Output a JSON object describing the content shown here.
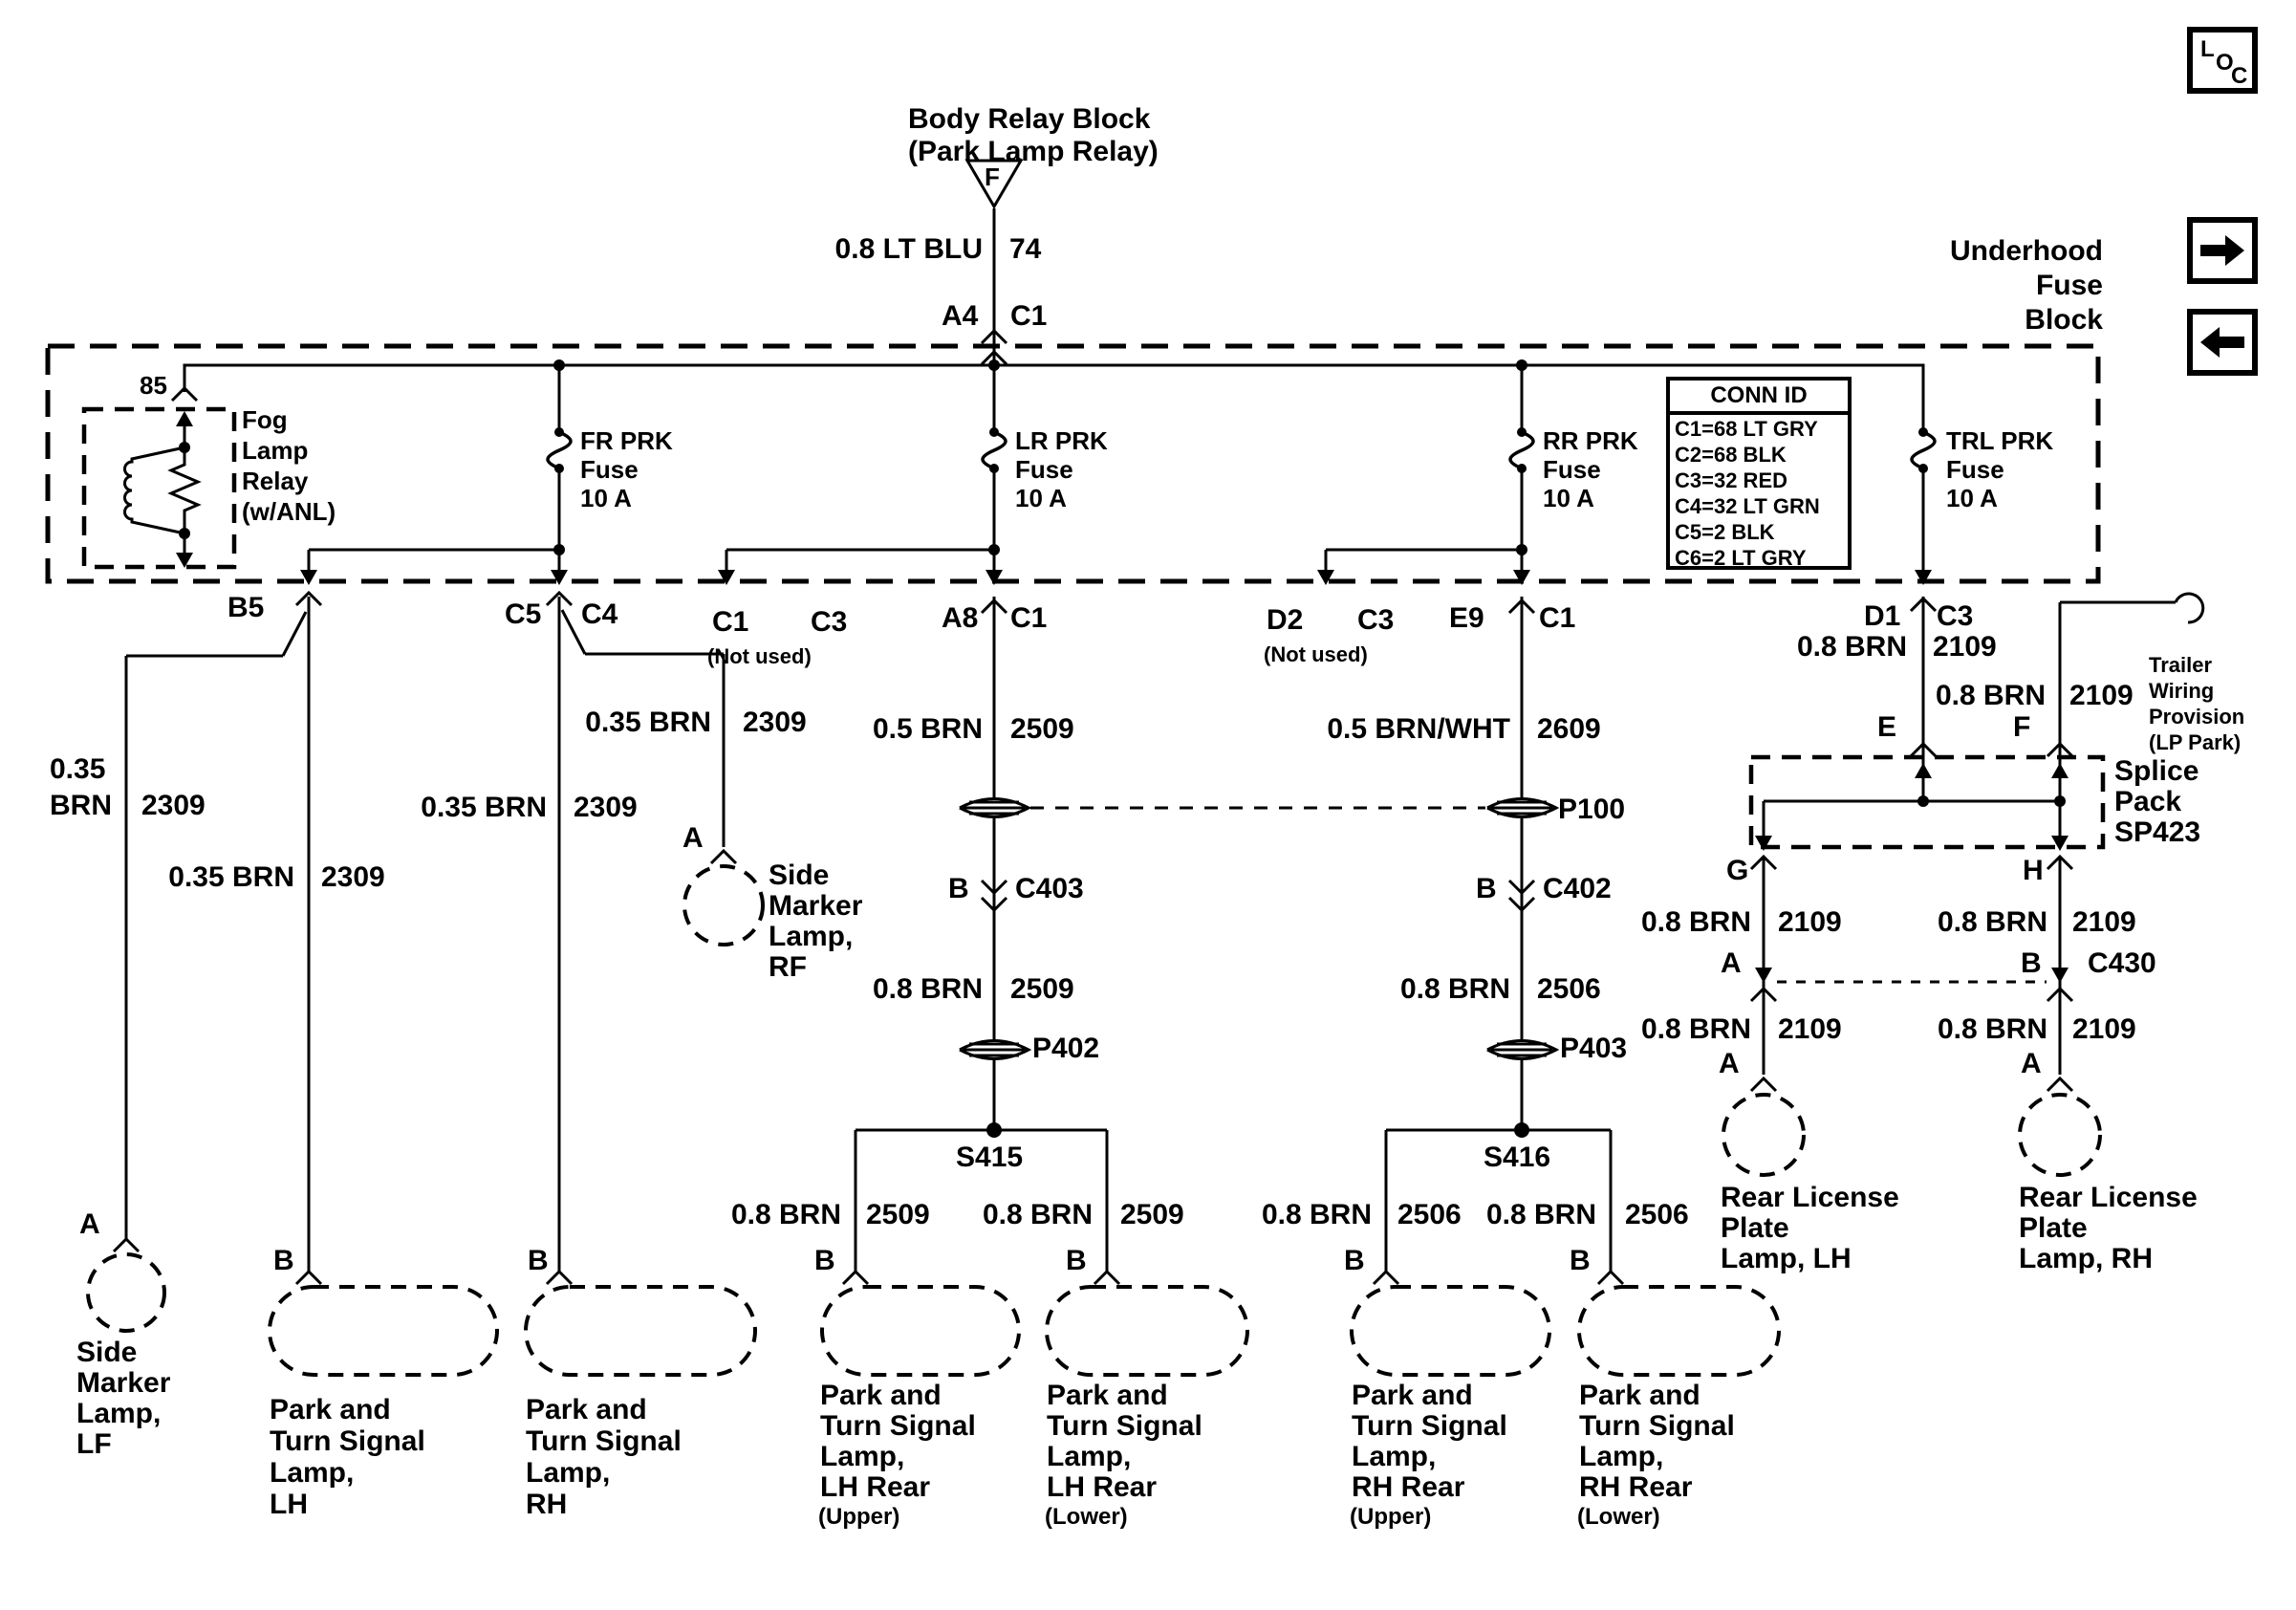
{
  "header": {
    "relay_block": [
      "Body Relay Block",
      "(Park Lamp Relay)"
    ],
    "triangle_letter": "F",
    "feed": {
      "color": "0.8 LT BLU",
      "circuit": "74",
      "pin": "A4",
      "conn": "C1"
    },
    "fuse_block_title": [
      "Underhood",
      "Fuse",
      "Block"
    ]
  },
  "nav": {
    "loc": [
      "L",
      "O",
      "C"
    ]
  },
  "fuse_block": {
    "relay": {
      "pin": "85",
      "name": [
        "Fog",
        "Lamp",
        "Relay",
        "(w/ANL)"
      ]
    },
    "fuses": {
      "fr": [
        "FR PRK",
        "Fuse",
        "10 A"
      ],
      "lr": [
        "LR PRK",
        "Fuse",
        "10 A"
      ],
      "rr": [
        "RR PRK",
        "Fuse",
        "10 A"
      ],
      "trl": [
        "TRL PRK",
        "Fuse",
        "10 A"
      ]
    },
    "conn_id": {
      "title": "CONN ID",
      "rows": [
        "C1=68 LT GRY",
        "C2=68 BLK",
        "C3=32 RED",
        "C4=32 LT GRN",
        "C5=2 BLK",
        "C6=2 LT GRY"
      ]
    }
  },
  "pins": {
    "b5": "B5",
    "c5": "C5",
    "c4": "C4",
    "nu1": {
      "a": "C1",
      "b": "C3",
      "note": "(Not used)"
    },
    "a8": {
      "pin": "A8",
      "conn": "C1"
    },
    "nu2": {
      "a": "D2",
      "b": "C3",
      "note": "(Not used)"
    },
    "e9": {
      "pin": "E9",
      "conn": "C1"
    },
    "d1": {
      "pin": "D1",
      "conn": "C3"
    }
  },
  "wires": {
    "lf": {
      "size": "0.35",
      "color": "BRN",
      "circuit": "2309"
    },
    "lh_front": {
      "color": "0.35 BRN",
      "circuit": "2309"
    },
    "rh_front": {
      "color": "0.35 BRN",
      "circuit": "2309"
    },
    "rf": {
      "color": "0.35 BRN",
      "circuit": "2309"
    },
    "lr_feed": {
      "color": "0.5 BRN",
      "circuit": "2509"
    },
    "lr_mid": {
      "color": "0.8 BRN",
      "circuit": "2509"
    },
    "lr_up": {
      "color": "0.8 BRN",
      "circuit": "2509"
    },
    "lr_low": {
      "color": "0.8 BRN",
      "circuit": "2509"
    },
    "rr_feed": {
      "color": "0.5 BRN/WHT",
      "circuit": "2609"
    },
    "rr_mid": {
      "color": "0.8 BRN",
      "circuit": "2506"
    },
    "rr_up": {
      "color": "0.8 BRN",
      "circuit": "2506"
    },
    "rr_low": {
      "color": "0.8 BRN",
      "circuit": "2506"
    },
    "trl": {
      "color": "0.8 BRN",
      "circuit": "2109"
    },
    "f": {
      "color": "0.8 BRN",
      "circuit": "2109"
    },
    "g1": {
      "color": "0.8 BRN",
      "circuit": "2109"
    },
    "h1": {
      "color": "0.8 BRN",
      "circuit": "2109"
    },
    "g2": {
      "color": "0.8 BRN",
      "circuit": "2109"
    },
    "h2": {
      "color": "0.8 BRN",
      "circuit": "2109"
    }
  },
  "connectors": {
    "c403": {
      "pin": "B",
      "name": "C403"
    },
    "c402": {
      "pin": "B",
      "name": "C402"
    },
    "c430": {
      "pin_a": "A",
      "pin_b": "B",
      "name": "C430"
    },
    "p402": "P402",
    "p403": "P403",
    "p100": "P100"
  },
  "splices": {
    "s415": "S415",
    "s416": "S416"
  },
  "splice_pack": {
    "name": [
      "Splice",
      "Pack",
      "SP423"
    ],
    "pin_e": "E",
    "pin_f": "F",
    "pin_g": "G",
    "pin_h": "H"
  },
  "trailer": {
    "label": [
      "Trailer",
      "Wiring",
      "Provision",
      "(LP Park)"
    ]
  },
  "lamps": {
    "sm_lf": {
      "pin": "A",
      "name": [
        "Side",
        "Marker",
        "Lamp,",
        "LF"
      ]
    },
    "sm_rf": {
      "pin": "A",
      "name": [
        "Side",
        "Marker",
        "Lamp,",
        "RF"
      ]
    },
    "pt_lh": {
      "pin": "B",
      "name": [
        "Park and",
        "Turn Signal",
        "Lamp,",
        "LH"
      ]
    },
    "pt_rh": {
      "pin": "B",
      "name": [
        "Park and",
        "Turn Signal",
        "Lamp,",
        "RH"
      ]
    },
    "pt_lhr_u": {
      "pin": "B",
      "name": [
        "Park and",
        "Turn Signal",
        "Lamp,",
        "LH Rear"
      ],
      "note": "(Upper)"
    },
    "pt_lhr_l": {
      "pin": "B",
      "name": [
        "Park and",
        "Turn Signal",
        "Lamp,",
        "LH Rear"
      ],
      "note": "(Lower)"
    },
    "pt_rhr_u": {
      "pin": "B",
      "name": [
        "Park and",
        "Turn Signal",
        "Lamp,",
        "RH Rear"
      ],
      "note": "(Upper)"
    },
    "pt_rhr_l": {
      "pin": "B",
      "name": [
        "Park and",
        "Turn Signal",
        "Lamp,",
        "RH Rear"
      ],
      "note": "(Lower)"
    },
    "rlp_lh": {
      "pin": "A",
      "name": [
        "Rear License",
        "Plate",
        "Lamp, LH"
      ]
    },
    "rlp_rh": {
      "pin": "A",
      "name": [
        "Rear License",
        "Plate",
        "Lamp, RH"
      ]
    }
  }
}
